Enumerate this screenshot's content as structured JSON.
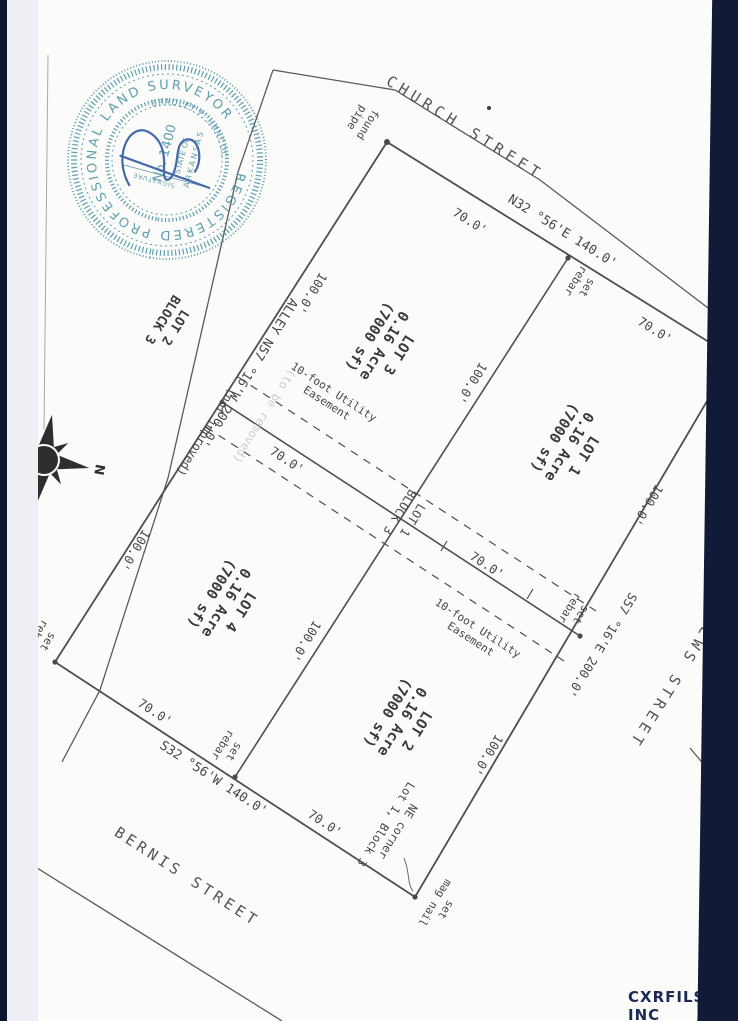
{
  "plat": {
    "streets": {
      "church": "CHURCH STREET",
      "matthews": "MATTHEWS STREET",
      "bernis": "BERNIS STREET"
    },
    "alley": {
      "label": "ALLEY  N57 °16'W  200.0'",
      "note": "(not improved)",
      "ghost_note": "(to be removed)"
    },
    "bearings": {
      "church_frontage": "N32 °56'E  140.0'",
      "bernis_frontage": "S32 °56'W  140.0'",
      "matthews_frontage": "S57 °16'E  200.0'",
      "edge_partial": "0.8 W"
    },
    "dimensions": {
      "seg70": "70.0'",
      "seg100": "100.0'"
    },
    "lots": {
      "lot1": {
        "name": "LOT 1",
        "acreage": "0.16 Acre",
        "area": "(7000 sf)"
      },
      "lot2": {
        "name": "LOT 2",
        "acreage": "0.16 Acre",
        "area": "(7000 sf)"
      },
      "lot3": {
        "name": "LOT 3",
        "acreage": "0.16 Acre",
        "area": "(7000 sf)"
      },
      "lot4": {
        "name": "LOT 4",
        "acreage": "0.16 Acre",
        "area": "(7000 sf)"
      }
    },
    "adjacent_lot": {
      "line1": "LOT 2",
      "line2": "BLOCK 3"
    },
    "center_label": {
      "line1": "LOT 1",
      "line2": "BLOCK 3"
    },
    "easement": {
      "line1": "10-foot Utility",
      "line2": "Easement"
    },
    "markers": {
      "found_pipe": {
        "line1": "found",
        "line2": "pipe"
      },
      "set_rebar": {
        "line1": "set",
        "line2": "rebar"
      },
      "set_mag_nail": {
        "line1": "set",
        "line2": "mag nail"
      }
    },
    "ne_corner_note": {
      "line1": "NE corner",
      "line2": "Lot 1, Block 3"
    },
    "north_arrow_label": "N"
  },
  "seal": {
    "ring": "REGISTERED   PROFESSIONAL   LAND   SURVEYOR",
    "state": "STATE OF",
    "state_name": "ARKANSAS",
    "number": "No. 1400",
    "name": "BRADLEY P. HANCOCK",
    "signature_label": "SIGNATURE"
  },
  "watermark": "CXRFILS, INC",
  "colors": {
    "seal_teal": "#4b93a6",
    "ink_blue": "#2d55a0",
    "line_grey": "#4f4f4f",
    "bar_navy": "#111b38"
  }
}
